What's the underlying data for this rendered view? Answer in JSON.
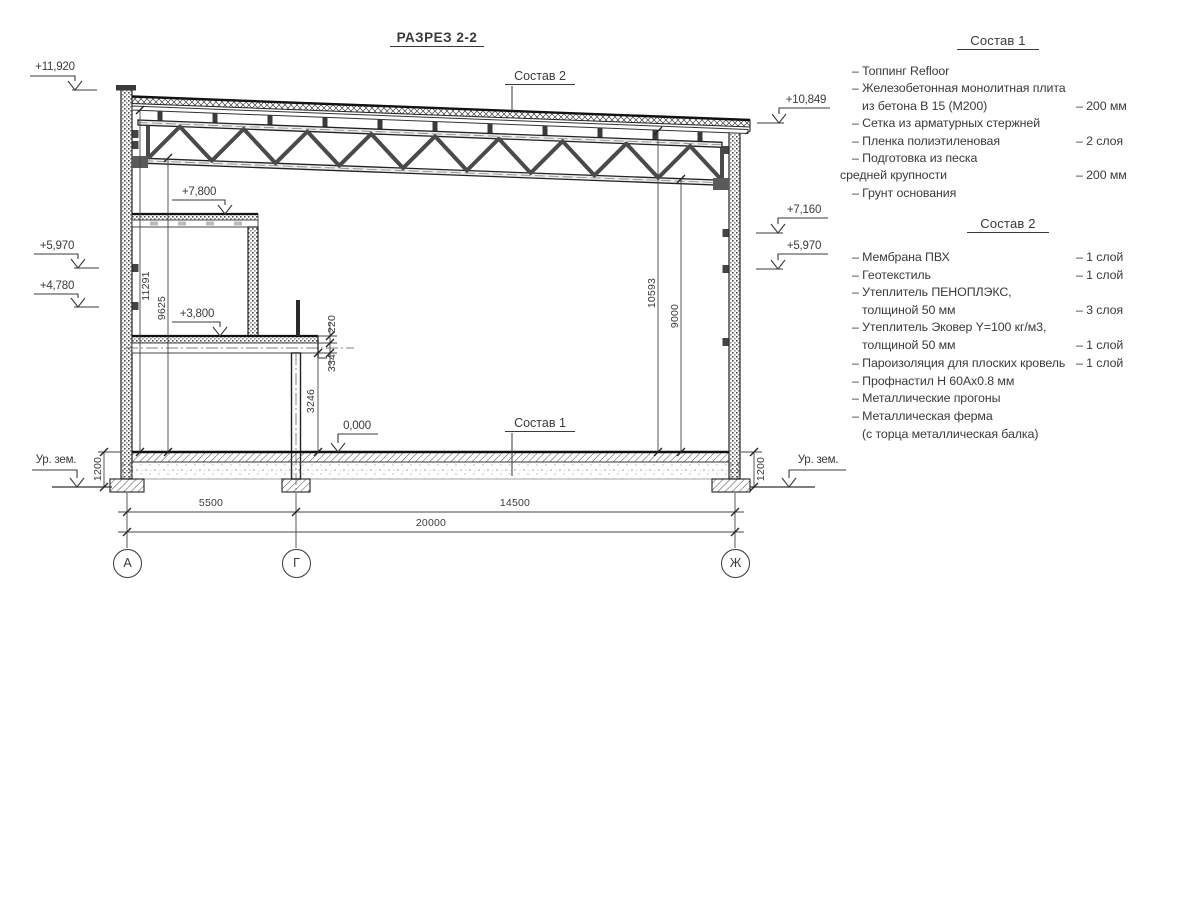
{
  "title": "РАЗРЕЗ 2-2",
  "callouts": {
    "roof": "Состав 2",
    "floor": "Состав 1"
  },
  "marks": {
    "left": [
      "+11,920",
      "+5,970",
      "+4,780"
    ],
    "right": [
      "+10,849",
      "+7,160",
      "+5,970"
    ],
    "mezz_upper": "+7,800",
    "mezz_lower": "+3,800",
    "zero": "0,000",
    "ground": "Ур. зем."
  },
  "dims": {
    "left_total": "11291",
    "left_inner": "9625",
    "right_total": "10593",
    "right_inner": "9000",
    "slab": "220",
    "beam": "334",
    "under_beam": "3246",
    "base_left": "1200",
    "base_right": "1200",
    "span_ag": "5500",
    "span_gz": "14500",
    "span_total": "20000"
  },
  "axes": {
    "a": "А",
    "g": "Г",
    "zh": "Ж"
  },
  "sostav1": {
    "title": "Состав 1",
    "rows": [
      {
        "label": "– Топпинг Refloor",
        "value": ""
      },
      {
        "label": "– Железобетонная  монолитная плита",
        "value": ""
      },
      {
        "label": "из бетона В 15 (М200)",
        "value": "– 200 мм"
      },
      {
        "label": "– Сетка из арматурных стержней",
        "value": ""
      },
      {
        "label": "– Пленка полиэтиленовая",
        "value": "– 2 слоя"
      },
      {
        "label": "– Подготовка из песка",
        "value": ""
      },
      {
        "label": "средней крупности",
        "value": "– 200 мм"
      },
      {
        "label": "– Грунт основания",
        "value": ""
      }
    ]
  },
  "sostav2": {
    "title": "Состав 2",
    "rows": [
      {
        "label": "– Мембрана ПВХ",
        "value": "– 1 слой"
      },
      {
        "label": "– Геотекстиль",
        "value": "– 1 слой"
      },
      {
        "label": "– Утеплитель ПЕНОПЛЭКС,",
        "value": ""
      },
      {
        "label": "толщиной 50 мм",
        "value": "– 3 слоя"
      },
      {
        "label": "– Утеплитель Эковер Y=100 кг/м3,",
        "value": ""
      },
      {
        "label": "толщиной 50 мм",
        "value": "– 1 слой"
      },
      {
        "label": "– Пароизоляция для плоских кровель",
        "value": "– 1 слой"
      },
      {
        "label": "– Профнастил Н 60Ах0.8 мм",
        "value": ""
      },
      {
        "label": "– Металлические прогоны",
        "value": ""
      },
      {
        "label": "– Металлическая ферма",
        "value": ""
      },
      {
        "label": "(с торца металлическая балка)",
        "value": ""
      }
    ]
  }
}
